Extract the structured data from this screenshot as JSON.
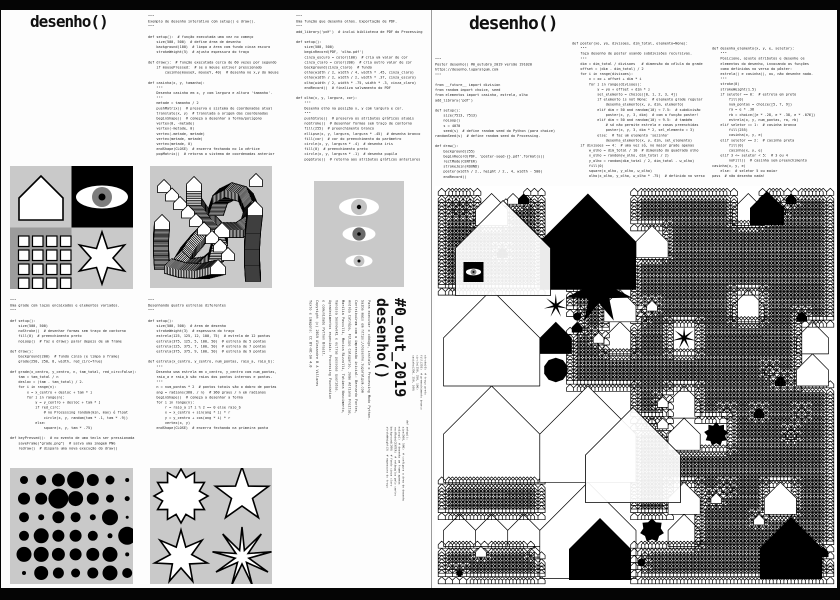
{
  "viewer": {
    "frame_color": "#050505",
    "paper_color": "#fdfdfd",
    "divider_color": "#9b9b9b"
  },
  "left_page": {
    "title": "desenho()",
    "code_interactive": [
      "\"\"\"",
      "Exemplo de desenho interativo com setup() e draw().",
      "\"\"\"",
      "",
      "def setup():  # função executada uma vez no começo",
      "    size(500, 500)  # define área de desenho",
      "    background(100)  # limpa a área com fundo cinza escuro",
      "    strokeWeight(5)  # ajusta espessura do traço",
      "",
      "def draw():  # função executada cerca de 60 vezes por segundo",
      "    if mousePressed:  # se o mouse estiver pressionado",
      "        casinha(mouseX, mouseY, 40)  # desenha no x,y do mouse",
      "",
      "def casinha(x, y, tamanho):",
      "    \"\"\"",
      "    Desenha casinha em x, y com largura e altura 'tamanho'.",
      "    \"\"\"",
      "    metade = tamanho / 2",
      "    pushMatrix()  # preserva o sistema de coordenadas atual",
      "    translate(x, y)  # translada a origem das coordenadas",
      "    beginShape()  # começa a desenhar a forma/polígono",
      "    vertex(0, -metade)",
      "    vertex(-metade, 0)",
      "    vertex(-metade, metade)",
      "    vertex(metade, metade)",
      "    vertex(metade, 0)",
      "    endShape(CLOSE)  # encerra fechando no 1o vértice",
      "    popMatrix()  # retorna o sistema de coordenadas anterior"
    ],
    "code_olhos": [
      "\"\"\"",
      "Uma função que desenha olhos. Exportação de PDF.",
      "\"\"\"",
      "add_library('pdf')  # inclui biblioteca de PDF do Processing",
      "",
      "def setup():",
      "    size(500, 500)",
      "    beginRecord(PDF, 'olho.pdf')",
      "    cinza_escuro = color(100)  # cria um valor de cor",
      "    cinza_claro = color(200)  # cria outro valor de cor",
      "    background(cinza_claro)  # fundo",
      "    olho(width / 2, width / 4, width * .45, cinza_claro)",
      "    olho(width / 2, width / 2, width * .37, cinza_escuro)",
      "    olho(width / 2, width * .75, width * .3, cinza_claro)",
      "    endRecord()  # finaliza salvamento do PDF",
      "",
      "def olho(x, y, largura, cor):",
      "    \"\"\"",
      "    Desenha olho na posição x, y com largura e cor.",
      "    \"\"\"",
      "    pushStyle()  # preserva os atributos gráficos atuais",
      "    noStroke()  # desenhar formas sem traço de contorno",
      "    fill(255)  # preenchimento branco",
      "    ellipse(x, y, largura, largura * .45)  # desenha branco",
      "    fill(cor)  # cor do preenchimento do parâmetro",
      "    circle(x, y, largura * .4)  # desenha íris",
      "    fill(0)  # preenchimento preto",
      "    circle(x, y, largura * .1)  # desenha pupila",
      "    popStyle()  # retorna aos atributos gráficos anteriores"
    ],
    "code_grade": [
      "\"\"\"",
      "Uma grade com laços encaixados e elementos variados.",
      "\"\"\"",
      "",
      "def setup():",
      "    size(500, 500)",
      "    noStroke()  # desenhar formas sem traço de contorno",
      "    fill(0)  # preenchimento preto",
      "    noLoop()  # faz o draw() parar depois de um frame",
      "",
      "def draw():",
      "    background(200)  # fundo cinza (e limpa o frame)",
      "    grade(250, 250, 8, width, red_circ=True)",
      "",
      "def grade(x_centro, y_centro, n, tam_total, red_circ=False):",
      "    tam = tam_total / n",
      "    desloc = (tam - tam_total) / 2.",
      "    for i in range(n):",
      "        x = x_centro + desloc + tam * i",
      "        for j in range(n):",
      "            y = y_centro + desloc + tam * j",
      "            if red_circ:",
      "                # no Processing random(min, max) é float",
      "                circle(x, y, random(tam * .1, tam * .9))",
      "            else:",
      "                square(x, y, tam * .75)",
      "",
      "def keyPressed():  # no evento de uma tecla ser pressionada",
      "    saveFrame(\"grade.png\")  # salva uma imagem PNG",
      "    redraw()  # dispara uma nova execução do draw()"
    ],
    "code_estrelas": [
      "\"\"\"",
      "Desenhando quatro estrelas diferentes",
      "\"\"\"",
      "",
      "def setup():",
      "    size(500, 500)  # área de desenho",
      "    strokeWeight(3)  # espessura do traço",
      "    estrela(125, 125, 12, 100, 75)  # estrela de 12 pontas",
      "    estrela(375, 125, 5, 100, 50)  # estrela de 5 pontas",
      "    estrela(125, 375, 7, 100, 50)  # estrela de 7 pontas",
      "    estrela(375, 375, 9, 100, 50)  # estrela de 9 pontas",
      "",
      "def estrela(x_centro, y_centro, num_pontas, raio_a, raio_b):",
      "    \"\"\"",
      "    Desenha uma estrela em x_centro, y_centro com num_pontas,",
      "    raio_a e raio_b são raios dos pontos internos e pontas.",
      "    \"\"\"",
      "    n = num_pontas * 2  # pontos totais são o dobro de pontas",
      "    ang = radians(360. / n)  # 360 graus / n em radianos",
      "    beginShape()  # começa a desenhar a forma",
      "    for i in range(n):",
      "        r = raio_a if i % 2 == 0 else raio_b",
      "        x = x_centro + sin(ang * i) * r",
      "        y = y_centro + cos(ang * i) * r",
      "        vertex(x, y)",
      "    endShape(CLOSE)  # encerra fechando na primeira ponta"
    ],
    "colophon": [
      "Para executar o código, instale o Processing Modo Python.",
      "Saiba mais em https://desenho.lugaralgum.com",
      "Contribuíram com a impressão inicial: Bernardo Fontes,",
      "Andréa Catrópa, Filipe Calegario, João Adriano Freitas,",
      "Marilia Pasculli, Monica Rizzolli, Tatiana Nascimento,",
      "Vanessa Sosnowski e outras pessoas queridas.",
      "Agradecimentos especiais: Processing Foundation",
      "e comunidade Python Brasil.",
      "Copyright (c) 2019 Alexandre B A Villares",
      "Texto e imagens: CC BY-NC-SA 4.0"
    ],
    "spine": {
      "issue": "#0_out_2019",
      "title": "desenho()",
      "code_a": [
        "def setup():",
        "    size(500, 500)  # configura a área de desenho",
        "    noLoop()  # desenha um frame apenas",
        "    rectMode(CENTER)  # retângulos pelo centro",
        "    background(200)  # fundo cinza claro",
        "    strokeWeight(3)  # espessura do traço"
      ],
      "code_b": [
        "stroke(0)  # traço preto",
        "fill(255)  # preenchimento branco",
        "circle(250, 250, 100)",
        "casinha(250, 250, 100)"
      ]
    },
    "images": {
      "grid2x2": {
        "bg_light": "#c9c9c9",
        "bg_dark": "#9c9c9c",
        "ink": "#000000",
        "paper": "#ffffff",
        "house": {
          "cx": 31,
          "cy": 32,
          "size": 44
        },
        "eye": {
          "cx": 92,
          "cy": 31,
          "rx": 26,
          "ry": 11.5,
          "iris_r": 10,
          "iris_color": "#7d7d7d",
          "pupil_r": 3.5
        },
        "squares": {
          "rows": 4,
          "cols": 4,
          "size": 10.5,
          "start": 8.5,
          "step": 14
        },
        "star": {
          "cx": 92,
          "cy": 92,
          "points": 6,
          "ra": 26,
          "rb": 11
        }
      },
      "worms": {
        "bg": "#c9c9c9",
        "stamp_size": 15,
        "ribbons": [
          {
            "step": 1.6,
            "pts": [
              [
                58,
                60
              ],
              [
                48,
                70
              ],
              [
                38,
                82
              ],
              [
                32,
                92
              ],
              [
                40,
                100
              ],
              [
                54,
                98
              ],
              [
                66,
                88
              ],
              [
                70,
                72
              ],
              [
                64,
                56
              ],
              [
                52,
                44
              ],
              [
                44,
                32
              ],
              [
                44,
                18
              ]
            ]
          },
          {
            "step": 1.4,
            "pts": [
              [
                66,
                42
              ],
              [
                70,
                30
              ],
              [
                82,
                24
              ],
              [
                96,
                28
              ],
              [
                102,
                42
              ],
              [
                98,
                56
              ],
              [
                86,
                64
              ],
              [
                72,
                64
              ]
            ]
          },
          {
            "step": 1.2,
            "pts": [
              [
                12,
                96
              ],
              [
                11,
                82
              ],
              [
                11,
                68
              ],
              [
                12,
                56
              ]
            ]
          },
          {
            "step": 1.5,
            "pts": [
              [
                22,
                100
              ],
              [
                36,
                104
              ],
              [
                52,
                105
              ],
              [
                68,
                101
              ]
            ]
          },
          {
            "step": 1.0,
            "pts": [
              [
                103,
                108
              ],
              [
                102,
                92
              ],
              [
                102,
                76
              ],
              [
                103,
                60
              ],
              [
                105,
                42
              ]
            ]
          },
          {
            "step": 11,
            "size": 13,
            "pts": [
              [
                14,
                20
              ],
              [
                78,
                88
              ]
            ]
          }
        ],
        "lone_house": {
          "x": 106,
          "y": 14,
          "size": 13
        }
      },
      "eyes": {
        "bg": "#c9c9c9",
        "cx": 45,
        "eyes": [
          {
            "cy": 26,
            "w": 40,
            "iris": "#c2c2c2",
            "iris_r": 8,
            "pupil_r": 2.2
          },
          {
            "cy": 53,
            "w": 33,
            "iris": "#6b6b6b",
            "iris_r": 6.6,
            "pupil_r": 1.8
          },
          {
            "cy": 80,
            "w": 27,
            "iris": "#c2c2c2",
            "iris_r": 5.4,
            "pupil_r": 1.5
          }
        ]
      },
      "dots": {
        "bg": "#c9c9c9",
        "x0": 14,
        "y0": 12,
        "dx": 17.2,
        "dy": 18.6,
        "diameters": [
          [
            8,
            10,
            13,
            17,
            12,
            9,
            4
          ],
          [
            12,
            12,
            20,
            15,
            12,
            8,
            5
          ],
          [
            10,
            6,
            12,
            10,
            6,
            16,
            3
          ],
          [
            10,
            15,
            12,
            12,
            10,
            5,
            18
          ],
          [
            15,
            15,
            13,
            12,
            13,
            15,
            4
          ],
          [
            4,
            14,
            11,
            9,
            11,
            15,
            10
          ]
        ]
      },
      "stars": {
        "bg": "#c9c9c9",
        "stars": [
          {
            "cx": 31,
            "cy": 28,
            "points": 12,
            "ra": 27,
            "rb": 19
          },
          {
            "cx": 92,
            "cy": 27,
            "points": 5,
            "ra": 28,
            "rb": 11
          },
          {
            "cx": 31,
            "cy": 89,
            "points": 7,
            "ra": 27,
            "rb": 11
          },
          {
            "cx": 92,
            "cy": 89,
            "points": 9,
            "ra": 30,
            "rb": 7
          }
        ]
      }
    }
  },
  "right_page": {
    "title": "desenho()",
    "code_setup": [
      "\"\"\"",
      "Poster desenho() #0_outubro_2019 versão 191020",
      "https://desenho.lugaralgum.com",
      "\"\"\"",
      "",
      "from __future__ import division",
      "from random import choice, seed",
      "from elementos import casinha, estrela, olho",
      "add_library('pdf')",
      "",
      "def setup():",
      "    size(7513, 7513)",
      "    noLoop()",
      "    s = 4070",
      "    seed(s)  # define random seed do Python (para choice)",
      "randomSeed(s)  # define random seed do Processing.",
      "",
      "def draw():",
      "    background(255)",
      "    beginRecord(PDF, 'poster-seed-{}.pdf'.format(s))",
      "    rectMode(CENTER)",
      "    strokeJoin(ROUND)",
      "    poster(width / 2., height / 2., 4, width - 500)",
      "    endRecord()"
    ],
    "code_poster": [
      "def poster(xo, yo, divisoes, dim_total, elemento=None):",
      "    \"\"\"",
      "    faça desenho de poster usando subdivisões recursivas.",
      "    \"\"\"",
      "    dim = dim_total / divisoes   # dimensão da célula da grade",
      "    offset = (dim - dim_total) / 2",
      "    for i in range(divisoes):",
      "        x = xo + offset + dim * i",
      "        for j in range(divisoes):",
      "            y = yo + offset + dim * j",
      "            sel_elemento = choice([0, 1, 2, 3, 4])",
      "            if elemento is not None:  # elemento grade regular",
      "                desenha_elemento(x, y, dim, elemento)",
      "            elif dim > 50 and random(10) < 7.5:  # subdivisão",
      "                poster(x, y, 3, dim)  # com a função poster!",
      "            elif dim < 50 and random(10) < 9.5:  # também",
      "                # só não permite estrela e casas preenchidas",
      "                poster(x, y, 3, dim * 2, sel_elemento = 3)",
      "            else:  # faz um elemento 'sozinho'",
      "                desenha_elemento(x, y, dim, sel_elemento)",
      "    if divisoes == 4:  # uma vez só, no maior grade apenas",
      "        w_olho = dim_total / 10  # dimensão do quadrado olho",
      "        x_olho = random(w_olho, dim_total / 2)",
      "        y_olho = random(dim_total / 2, dim_total - w_olho)",
      "        fill(0)",
      "        square(x_olho, y_olho, w_olho)",
      "        olho(x_olho, y_olho, w_olho * .75)  # definido no verso"
    ],
    "code_elemento": [
      "def desenha_elemento(x, y, e, seletor):",
      "    \"\"\"",
      "    Posicione, ajuste atributos e desenhe os",
      "    elementos do desenho, invocando as funções",
      "    como definidas no verso do pôster:",
      "    estrela() e casinha(), ou, não desenhe nada.",
      "    \"\"\"",
      "    stroke(0)",
      "    strokeWeight(1.5)",
      "    if seletor == 0:  # estrela em preto",
      "        fill(0)",
      "        num_pontas = choice([5, 7, 9])",
      "        ra = e * .38",
      "        rb = choice([e * .28, e * .38, e * .076])",
      "        estrela(x, y, num_pontas, ra, rb)",
      "    elif seletor == 1:  # casinha branca",
      "        fill(255)",
      "        casinha(x, y, e)",
      "    elif seletor == 2:  # casinha preta",
      "        fill(0)",
      "        casinha(x, y, e)",
      "    elif 3 <= seletor < 5:  # 3 ou 4",
      "        noFill()  # casinha sem preenchimento",
      "casinha(x, y, e)",
      "    else:  # seletor 5 ou maior",
      "pass  # não desenha nada!"
    ],
    "artwork": {
      "seed": 4070,
      "divisions": 4,
      "dim_total": 385,
      "subdivide_threshold": 13,
      "subdivide_prob": 7.5,
      "texture_prob": 9.5,
      "ink": "#000000",
      "paper": "#ffffff",
      "overlays": {
        "outline_houses": [
          {
            "x": 68,
            "y": 62,
            "s": 95
          },
          {
            "x": 198,
            "y": 269,
            "s": 95
          }
        ],
        "black_houses": [
          {
            "x": 165,
            "y": 363,
            "s": 62
          },
          {
            "x": 356,
            "y": 362,
            "s": 62
          },
          {
            "x": 332,
            "y": 22,
            "s": 34
          }
        ],
        "big_star": {
          "x": 164,
          "y": 104,
          "points": 7,
          "ra": 34,
          "rb": 13
        },
        "eye_square": {
          "x": 38.5,
          "y": 86,
          "s": 20,
          "iris_color": "#8a8a8a"
        }
      }
    }
  }
}
